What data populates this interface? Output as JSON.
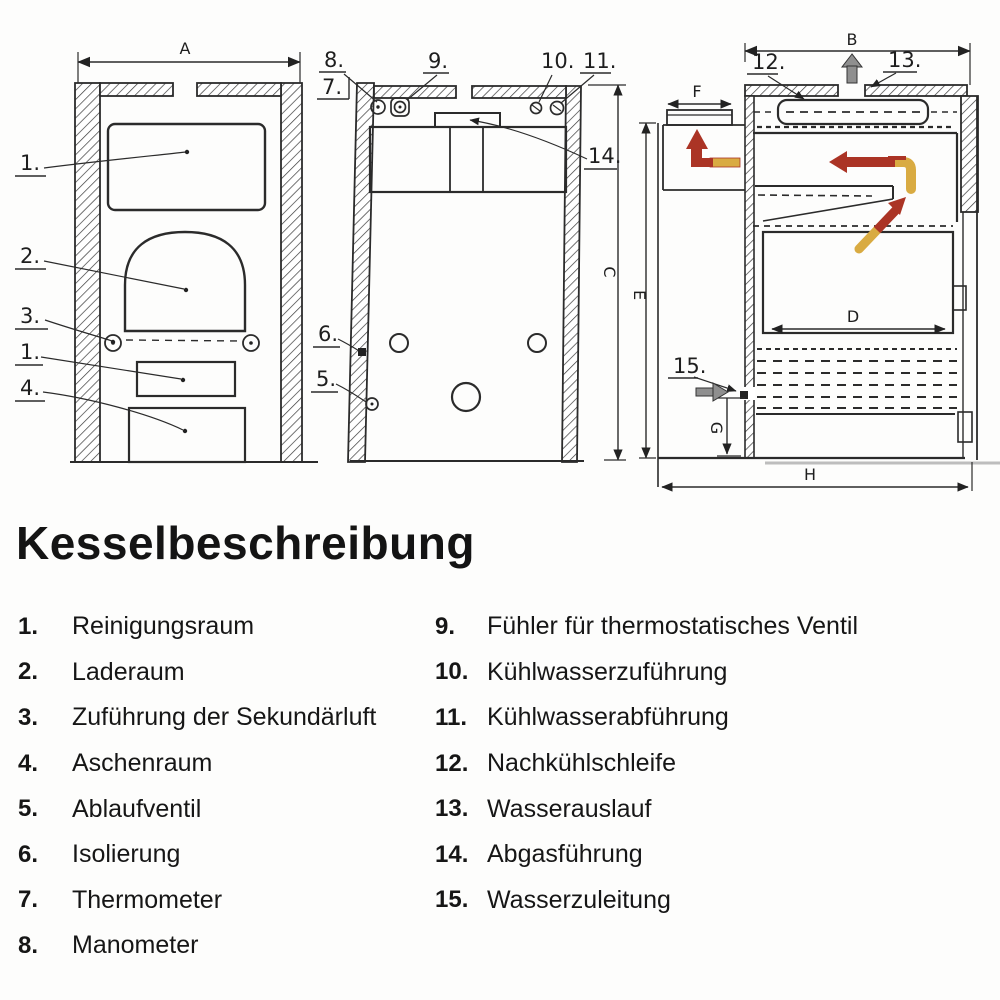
{
  "title": "Kesselbeschreibung",
  "legend": {
    "left": [
      {
        "num": "1.",
        "label": "Reinigungsraum"
      },
      {
        "num": "2.",
        "label": "Laderaum"
      },
      {
        "num": "3.",
        "label": "Zuführung der Sekundärluft"
      },
      {
        "num": "4.",
        "label": "Aschenraum"
      },
      {
        "num": "5.",
        "label": "Ablaufventil"
      },
      {
        "num": "6.",
        "label": "Isolierung"
      },
      {
        "num": "7.",
        "label": "Thermometer"
      },
      {
        "num": "8.",
        "label": "Manometer"
      }
    ],
    "right": [
      {
        "num": "9.",
        "label": "Fühler für thermostatisches Ventil"
      },
      {
        "num": "10.",
        "label": "Kühlwasserzuführung"
      },
      {
        "num": "11.",
        "label": "Kühlwasserabführung"
      },
      {
        "num": "12.",
        "label": "Nachkühlschleife"
      },
      {
        "num": "13.",
        "label": "Wasserauslauf"
      },
      {
        "num": "14.",
        "label": "Abgasführung"
      },
      {
        "num": "15.",
        "label": "Wasserzuleitung"
      }
    ]
  },
  "diagram": {
    "dims": {
      "a": "A",
      "b": "B",
      "c": "C",
      "d": "D",
      "e": "E",
      "f": "F",
      "g": "G",
      "h": "H"
    },
    "callouts": {
      "c1": "1.",
      "c1b": "1.",
      "c2": "2.",
      "c3": "3.",
      "c4": "4.",
      "c5": "5.",
      "c6": "6.",
      "c7": "7.",
      "c8": "8.",
      "c9": "9.",
      "c10": "10.",
      "c11": "11.",
      "c12": "12.",
      "c13": "13.",
      "c14": "14.",
      "c15": "15."
    },
    "colors": {
      "ink": "#242424",
      "flow_red": "#ab3425",
      "flow_gold": "#d9ab42",
      "water_gray": "#8f8f8f"
    }
  }
}
